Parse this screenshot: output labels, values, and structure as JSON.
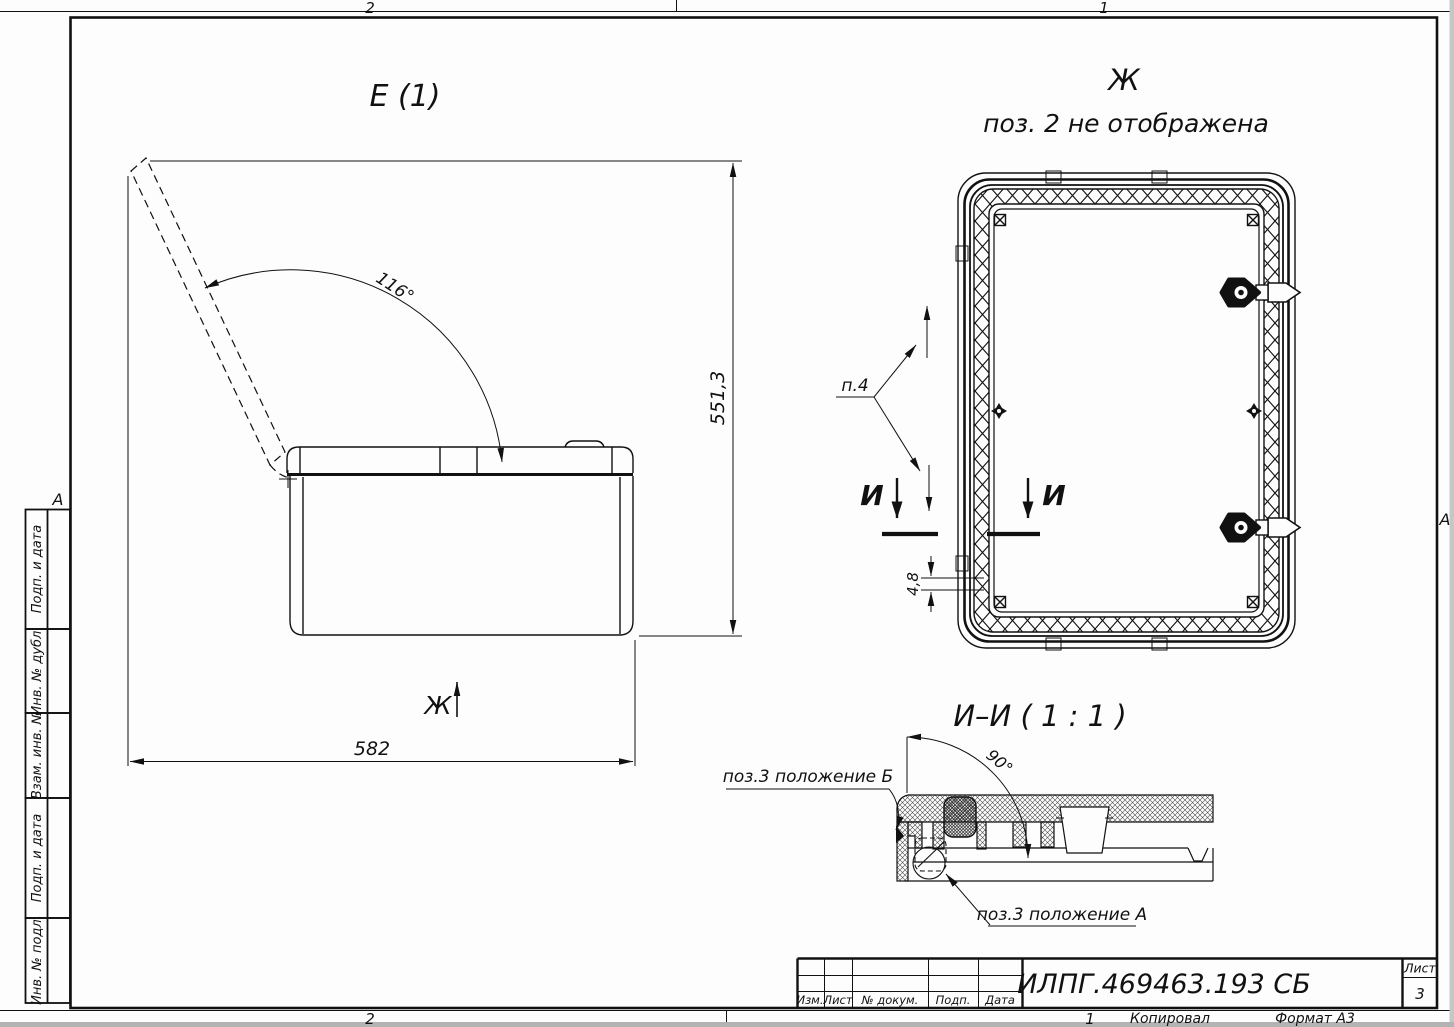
{
  "frame": {
    "zone_top_left": "2",
    "zone_top_right": "1",
    "zone_bottom_left": "2",
    "zone_bottom_right": "1",
    "zone_side_left": "А",
    "zone_side_right": "А",
    "copied_label": "Копировал",
    "format_label": "Формат А3"
  },
  "sidebar": {
    "items": [
      {
        "label": "Подп. и дата"
      },
      {
        "label": "Инв. № дубл."
      },
      {
        "label": "Взам. инв. №"
      },
      {
        "label": "Подп. и дата"
      },
      {
        "label": "Инв. № подл."
      }
    ]
  },
  "title_block": {
    "doc_number": "ИЛПГ.469463.193 СБ",
    "sheet_label": "Лист",
    "sheet_number": "3",
    "columns": [
      "Изм.",
      "Лист",
      "№ докум.",
      "Подп.",
      "Дата"
    ]
  },
  "view_e": {
    "title": "Е (1)",
    "angle": "116°",
    "dim_width": "582",
    "dim_height": "551,3",
    "view_arrow_label": "Ж"
  },
  "view_zh": {
    "title": "Ж",
    "subtitle": "поз. 2 не отображена",
    "note": "п.4",
    "dim_thickness": "4,8",
    "section_letter_left": "И",
    "section_letter_right": "И"
  },
  "section_ii": {
    "title": "И–И ( 1 : 1 )",
    "angle": "90°",
    "label_pos_b": "поз.3 положение Б",
    "label_pos_a": "поз.3 положение А"
  }
}
